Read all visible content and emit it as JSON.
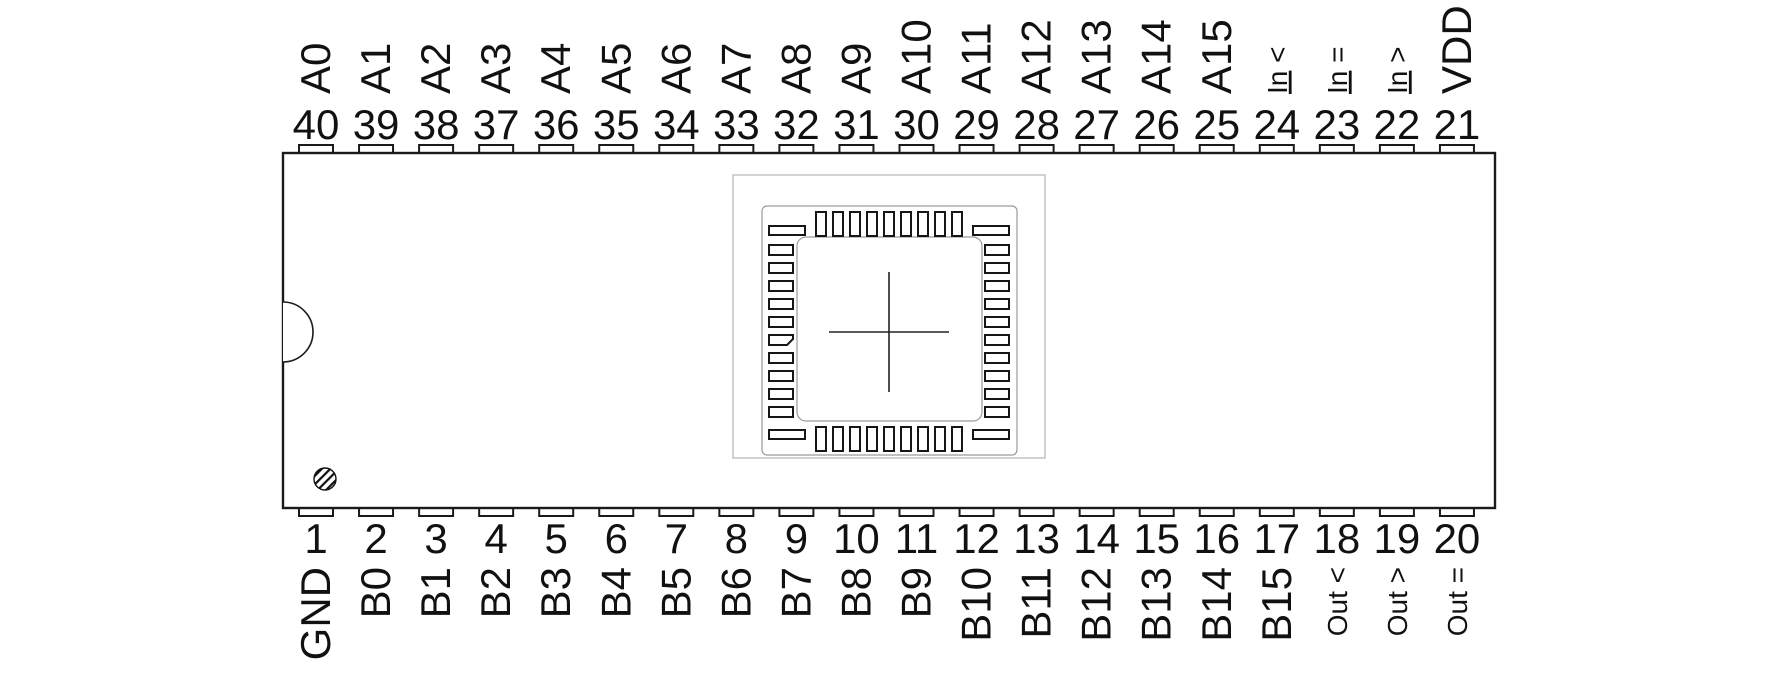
{
  "pins": {
    "top": [
      {
        "num": "40",
        "label": "A0"
      },
      {
        "num": "39",
        "label": "A1"
      },
      {
        "num": "38",
        "label": "A2"
      },
      {
        "num": "37",
        "label": "A3"
      },
      {
        "num": "36",
        "label": "A4"
      },
      {
        "num": "35",
        "label": "A5"
      },
      {
        "num": "34",
        "label": "A6"
      },
      {
        "num": "33",
        "label": "A7"
      },
      {
        "num": "32",
        "label": "A8"
      },
      {
        "num": "31",
        "label": "A9"
      },
      {
        "num": "30",
        "label": "A10"
      },
      {
        "num": "29",
        "label": "A11"
      },
      {
        "num": "28",
        "label": "A12"
      },
      {
        "num": "27",
        "label": "A13"
      },
      {
        "num": "26",
        "label": "A14"
      },
      {
        "num": "25",
        "label": "A15"
      },
      {
        "num": "24",
        "label": "In <",
        "underline": true,
        "small": true
      },
      {
        "num": "23",
        "label": "In =",
        "underline": true,
        "small": true
      },
      {
        "num": "22",
        "label": "In >",
        "underline": true,
        "small": true
      },
      {
        "num": "21",
        "label": "VDD"
      }
    ],
    "bottom": [
      {
        "num": "1",
        "label": "GND"
      },
      {
        "num": "2",
        "label": "B0"
      },
      {
        "num": "3",
        "label": "B1"
      },
      {
        "num": "4",
        "label": "B2"
      },
      {
        "num": "5",
        "label": "B3"
      },
      {
        "num": "6",
        "label": "B4"
      },
      {
        "num": "7",
        "label": "B5"
      },
      {
        "num": "8",
        "label": "B6"
      },
      {
        "num": "9",
        "label": "B7"
      },
      {
        "num": "10",
        "label": "B8"
      },
      {
        "num": "11",
        "label": "B9"
      },
      {
        "num": "12",
        "label": "B10"
      },
      {
        "num": "13",
        "label": "B11"
      },
      {
        "num": "14",
        "label": "B12"
      },
      {
        "num": "15",
        "label": "B13"
      },
      {
        "num": "16",
        "label": "B14"
      },
      {
        "num": "17",
        "label": "B15"
      },
      {
        "num": "18",
        "label": "Out <",
        "small": true
      },
      {
        "num": "19",
        "label": "Out >",
        "small": true
      },
      {
        "num": "20",
        "label": "Out =",
        "small": true
      }
    ]
  },
  "colors": {
    "line": "#1a1a1a",
    "light_line": "#9a9a9a",
    "text": "#111111",
    "background": "#ffffff"
  }
}
